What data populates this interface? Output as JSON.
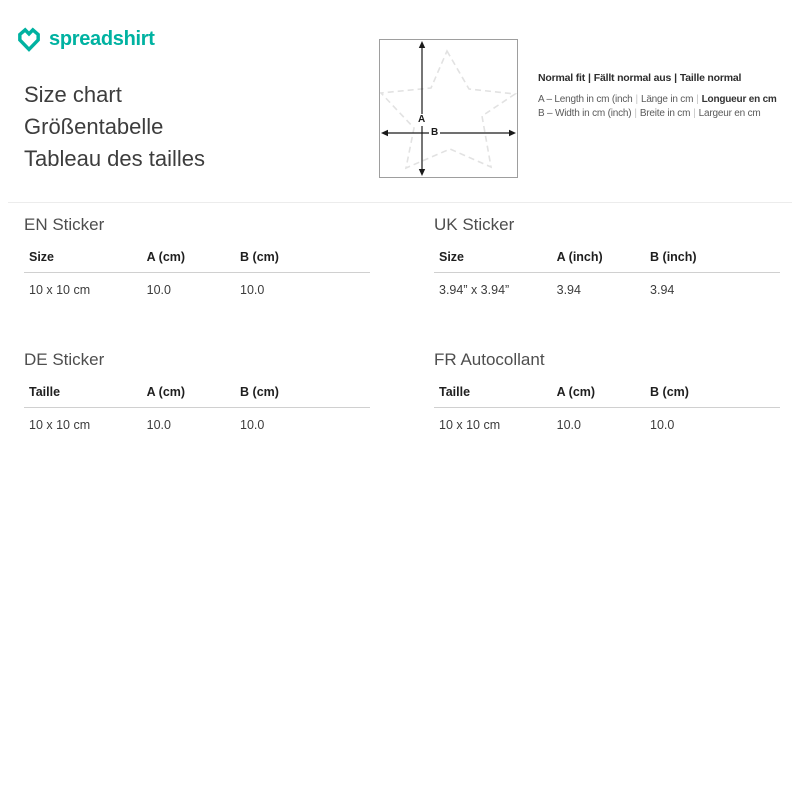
{
  "colors": {
    "brand_teal": "#00b2a1",
    "heading_text": "#3d3d3d",
    "table_title_gray": "#4e4e4e",
    "divider": "#ececec",
    "header_underline": "#d0d0d0",
    "diagram_border": "#9e9e9e",
    "star_dash": "#e2e2e2",
    "arrow_black": "#1a1a1a"
  },
  "brand": {
    "wordmark": "spreadshirt"
  },
  "header": {
    "titles": [
      "Size chart",
      "Größentabelle",
      "Tableau des tailles"
    ]
  },
  "diagram": {
    "shape": "star",
    "label_a": "A",
    "label_b": "B"
  },
  "legend": {
    "sep": "|",
    "fit": [
      "Normal fit",
      "Fällt normal aus",
      "Taille normal"
    ],
    "line_a": [
      "A – Length in cm (inch",
      "Länge in cm",
      "Longueur en cm"
    ],
    "line_b": [
      "B – Width in cm (inch)",
      "Breite in cm",
      "Largeur en cm"
    ]
  },
  "tables": [
    {
      "title": "EN Sticker",
      "headers": [
        "Size",
        "A (cm)",
        "B (cm)"
      ],
      "rows": [
        [
          "10 x 10 cm",
          "10.0",
          "10.0"
        ]
      ]
    },
    {
      "title": "UK Sticker",
      "headers": [
        "Size",
        "A (inch)",
        "B (inch)"
      ],
      "rows": [
        [
          "3.94” x 3.94”",
          "3.94",
          "3.94"
        ]
      ]
    },
    {
      "title": "DE Sticker",
      "headers": [
        "Taille",
        "A (cm)",
        "B (cm)"
      ],
      "rows": [
        [
          "10 x 10 cm",
          "10.0",
          "10.0"
        ]
      ]
    },
    {
      "title": "FR Autocollant",
      "headers": [
        "Taille",
        "A (cm)",
        "B (cm)"
      ],
      "rows": [
        [
          "10 x 10 cm",
          "10.0",
          "10.0"
        ]
      ]
    }
  ]
}
